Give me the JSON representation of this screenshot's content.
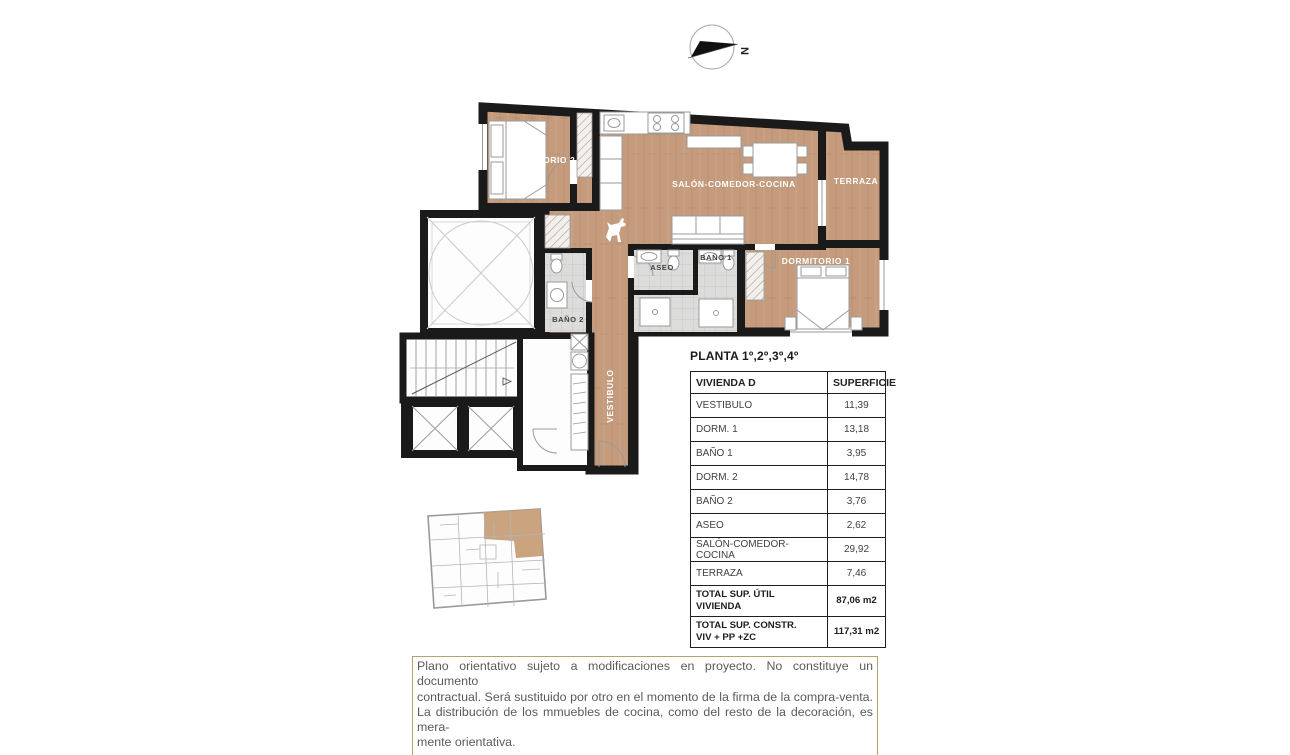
{
  "compass": {
    "label": "N"
  },
  "plan": {
    "rooms": [
      {
        "id": "dormitorio-2",
        "label": "DORMITORIO 2"
      },
      {
        "id": "salon-comedor-cocina",
        "label": "SALÓN-COMEDOR-COCINA"
      },
      {
        "id": "terraza",
        "label": "TERRAZA"
      },
      {
        "id": "dormitorio-1",
        "label": "DORMITORIO 1"
      },
      {
        "id": "bano-1",
        "label": "BAÑO 1"
      },
      {
        "id": "aseo",
        "label": "ASEO"
      },
      {
        "id": "bano-2",
        "label": "BAÑO 2"
      },
      {
        "id": "vestibulo",
        "label": "VESTIBULO"
      }
    ]
  },
  "table": {
    "title": "PLANTA 1º,2º,3º,4º",
    "header": [
      "VIVIENDA D",
      "SUPERFICIE"
    ],
    "rows": [
      [
        "VESTIBULO",
        "11,39"
      ],
      [
        "DORM. 1",
        "13,18"
      ],
      [
        "BAÑO 1",
        "3,95"
      ],
      [
        "DORM. 2",
        "14,78"
      ],
      [
        "BAÑO 2",
        "3,76"
      ],
      [
        "ASEO",
        "2,62"
      ],
      [
        "SALÓN-COMEDOR-COCINA",
        "29,92"
      ],
      [
        "TERRAZA",
        "7,46"
      ]
    ],
    "totals": [
      {
        "label_lines": [
          "TOTAL SUP. ÚTIL VIVIENDA"
        ],
        "value": "87,06 m2"
      },
      {
        "label_lines": [
          "TOTAL SUP. CONSTR.",
          "VIV + PP +ZC"
        ],
        "value": "117,31 m2"
      }
    ]
  },
  "disclaimer": {
    "lines": [
      "Plano orientativo sujeto a modificaciones en proyecto. No constituye un documento",
      "contractual. Será sustituido por otro en el momento de la firma de la compra-venta.",
      "La distribución de los mmuebles de cocina, como del resto de la decoración, es mera-",
      "mente orientativa."
    ]
  },
  "colors": {
    "wood": "#c59b7d",
    "wall": "#1a1a1a",
    "bath_tile": "#dcdcda",
    "keyplan_highlight": "#c79e78",
    "disclaimer_border": "#b3a274",
    "table_border": "#1f1f1f"
  }
}
